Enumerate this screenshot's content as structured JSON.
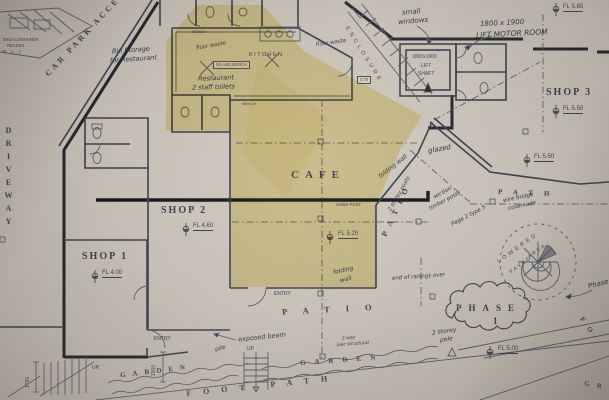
{
  "title": "Scanned architectural site floor plan with highlighted cafe area",
  "colors": {
    "paper": "#c5beb5",
    "ink": "#454a55",
    "heavy_line": "#1f2127",
    "highlight": "#ecd96d",
    "handwriting": "#2e3542"
  },
  "labels": {
    "car_park_access": "CAR PARK ACCESS",
    "driveway": "DRIVEWAY",
    "shop1": "SHOP 1",
    "shop2": "SHOP 2",
    "shop3": "SHOP 3",
    "cafe": "CAFE",
    "kitchen": "KITCHEN",
    "island_bench": "ISLAND BENCH",
    "bench_top": "BENCH",
    "bench_bottom": "BENCH",
    "lift_dim": "1800x1900",
    "lift_line1": "LIFT",
    "lift_line2": "SHAFT",
    "patio_bottom": "PATIO",
    "patio_side": "PATIO",
    "path_upper": "PATH",
    "footpath": "FOOT PATH",
    "garden_left": "GARDEN",
    "garden_right": "GARDEN",
    "phase_word": "PHASE",
    "phase_num": "1",
    "lowered": "LOWERED",
    "paved": "PAVED",
    "area_word": "AREA",
    "enclosure": "ENCLOSURE",
    "entry_shop1": "ENTRY",
    "entry_patio": "ENTRY",
    "up_left": "UP.",
    "up_mid": "UP",
    "sawn_post": "SAWN POST",
    "bins_line1": "BINS-CONTAINER",
    "bins_line2": "RECESS",
    "bins_line3": "R A L",
    "fo_edge": "F O",
    "gro_edge": "G R O",
    "dim_1500": "1500",
    "dim_1795": "1795",
    "small_470": "4.70"
  },
  "levels": {
    "l585": "FL 5.85",
    "l550a": "FL 5.50",
    "l550b": "FL 5.50",
    "l520": "FL 5.20",
    "l460": "FL 4.60",
    "l400": "FL 4.00",
    "l500": "FL 5.00"
  },
  "annotations": {
    "bin_storage1": "Bin Storage",
    "bin_storage2": "for Restaurant",
    "small_windows1": "small",
    "small_windows2": "windows",
    "lift_motor1": "1800 x 1900",
    "lift_motor2": "LIFT MOTOR ROOM",
    "floor_waste_a": "floor waste",
    "floor_waste_b": "floor waste",
    "restaurant1": "Restaurant",
    "restaurant2": "2 staff toilets",
    "glazed": "glazed",
    "folding_wall_a": "folding wall",
    "folding_wall_b1": "folding",
    "folding_wall_b2": "wall",
    "timber1": "section",
    "timber2": "timber posts",
    "page_type": "Page 2 type 5",
    "storey_posts": "2 storey posts",
    "storey_pole1": "2 storey",
    "storey_pole2": "pole",
    "railings": "end of railings over",
    "wire1": "wire bridge",
    "wire2": "colonnade",
    "exposed_beam": "exposed beam",
    "pile": "pile",
    "pier1": "2 way",
    "pier2": "pier structural",
    "phase_hand": "Phase"
  }
}
